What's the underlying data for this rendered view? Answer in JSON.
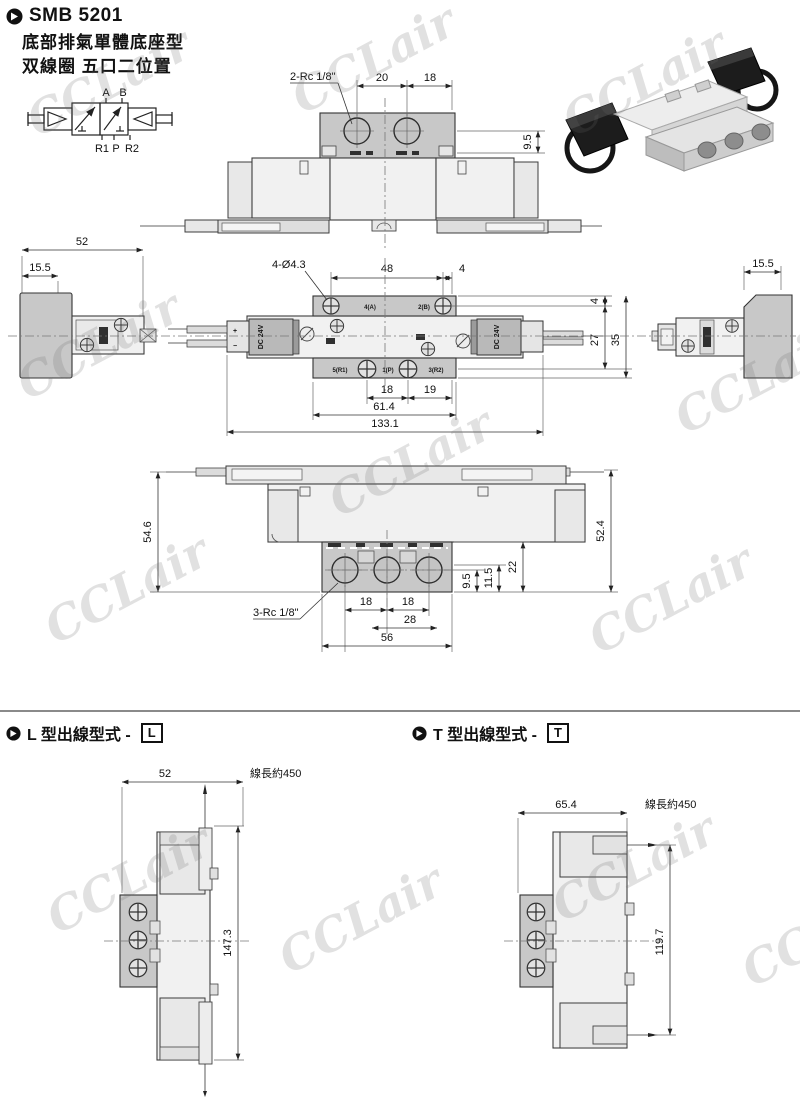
{
  "header": {
    "title": "SMB 5201",
    "subtitle1": "底部排氣單體底座型",
    "subtitle2": "双線圈 五口二位置"
  },
  "watermark": {
    "text": "CCLair"
  },
  "symbol": {
    "port_a": "A",
    "port_b": "B",
    "port_r1": "R1",
    "port_p": "P",
    "port_r2": "R2"
  },
  "top_view": {
    "thread_label": "2-Rc 1/8\"",
    "dim_20": "20",
    "dim_18": "18",
    "dim_9_5": "9.5"
  },
  "front_view": {
    "holes_label": "4-Ø4.3",
    "dim_48": "48",
    "dim_4_top": "4",
    "dim_52": "52",
    "dim_15_5_left": "15.5",
    "dim_15_5_right": "15.5",
    "dim_4_right": "4",
    "dim_27": "27",
    "dim_35": "35",
    "dim_18": "18",
    "dim_19": "19",
    "dim_61_4": "61.4",
    "dim_133_1": "133.1",
    "coil_label_left": "DC 24V",
    "coil_label_right": "DC 24V",
    "mark_4a": "4(A)",
    "mark_2b": "2(B)",
    "mark_5r1": "5(R1)",
    "mark_1p": "1(P)",
    "mark_3r2": "3(R2)"
  },
  "bottom_view": {
    "dim_54_6": "54.6",
    "dim_52_4": "52.4",
    "dim_22": "22",
    "dim_11_5": "11.5",
    "dim_9_5": "9.5",
    "thread_label": "3-Rc 1/8\"",
    "dim_18_a": "18",
    "dim_18_b": "18",
    "dim_28": "28",
    "dim_56": "56"
  },
  "l_section": {
    "heading": "L 型出線型式 -",
    "code": "L",
    "dim_52": "52",
    "wire_label": "線長約450",
    "dim_147_3": "147.3"
  },
  "t_section": {
    "heading": "T 型出線型式 -",
    "code": "T",
    "dim_65_4": "65.4",
    "wire_label": "線長約450",
    "dim_119_7": "119.7"
  }
}
